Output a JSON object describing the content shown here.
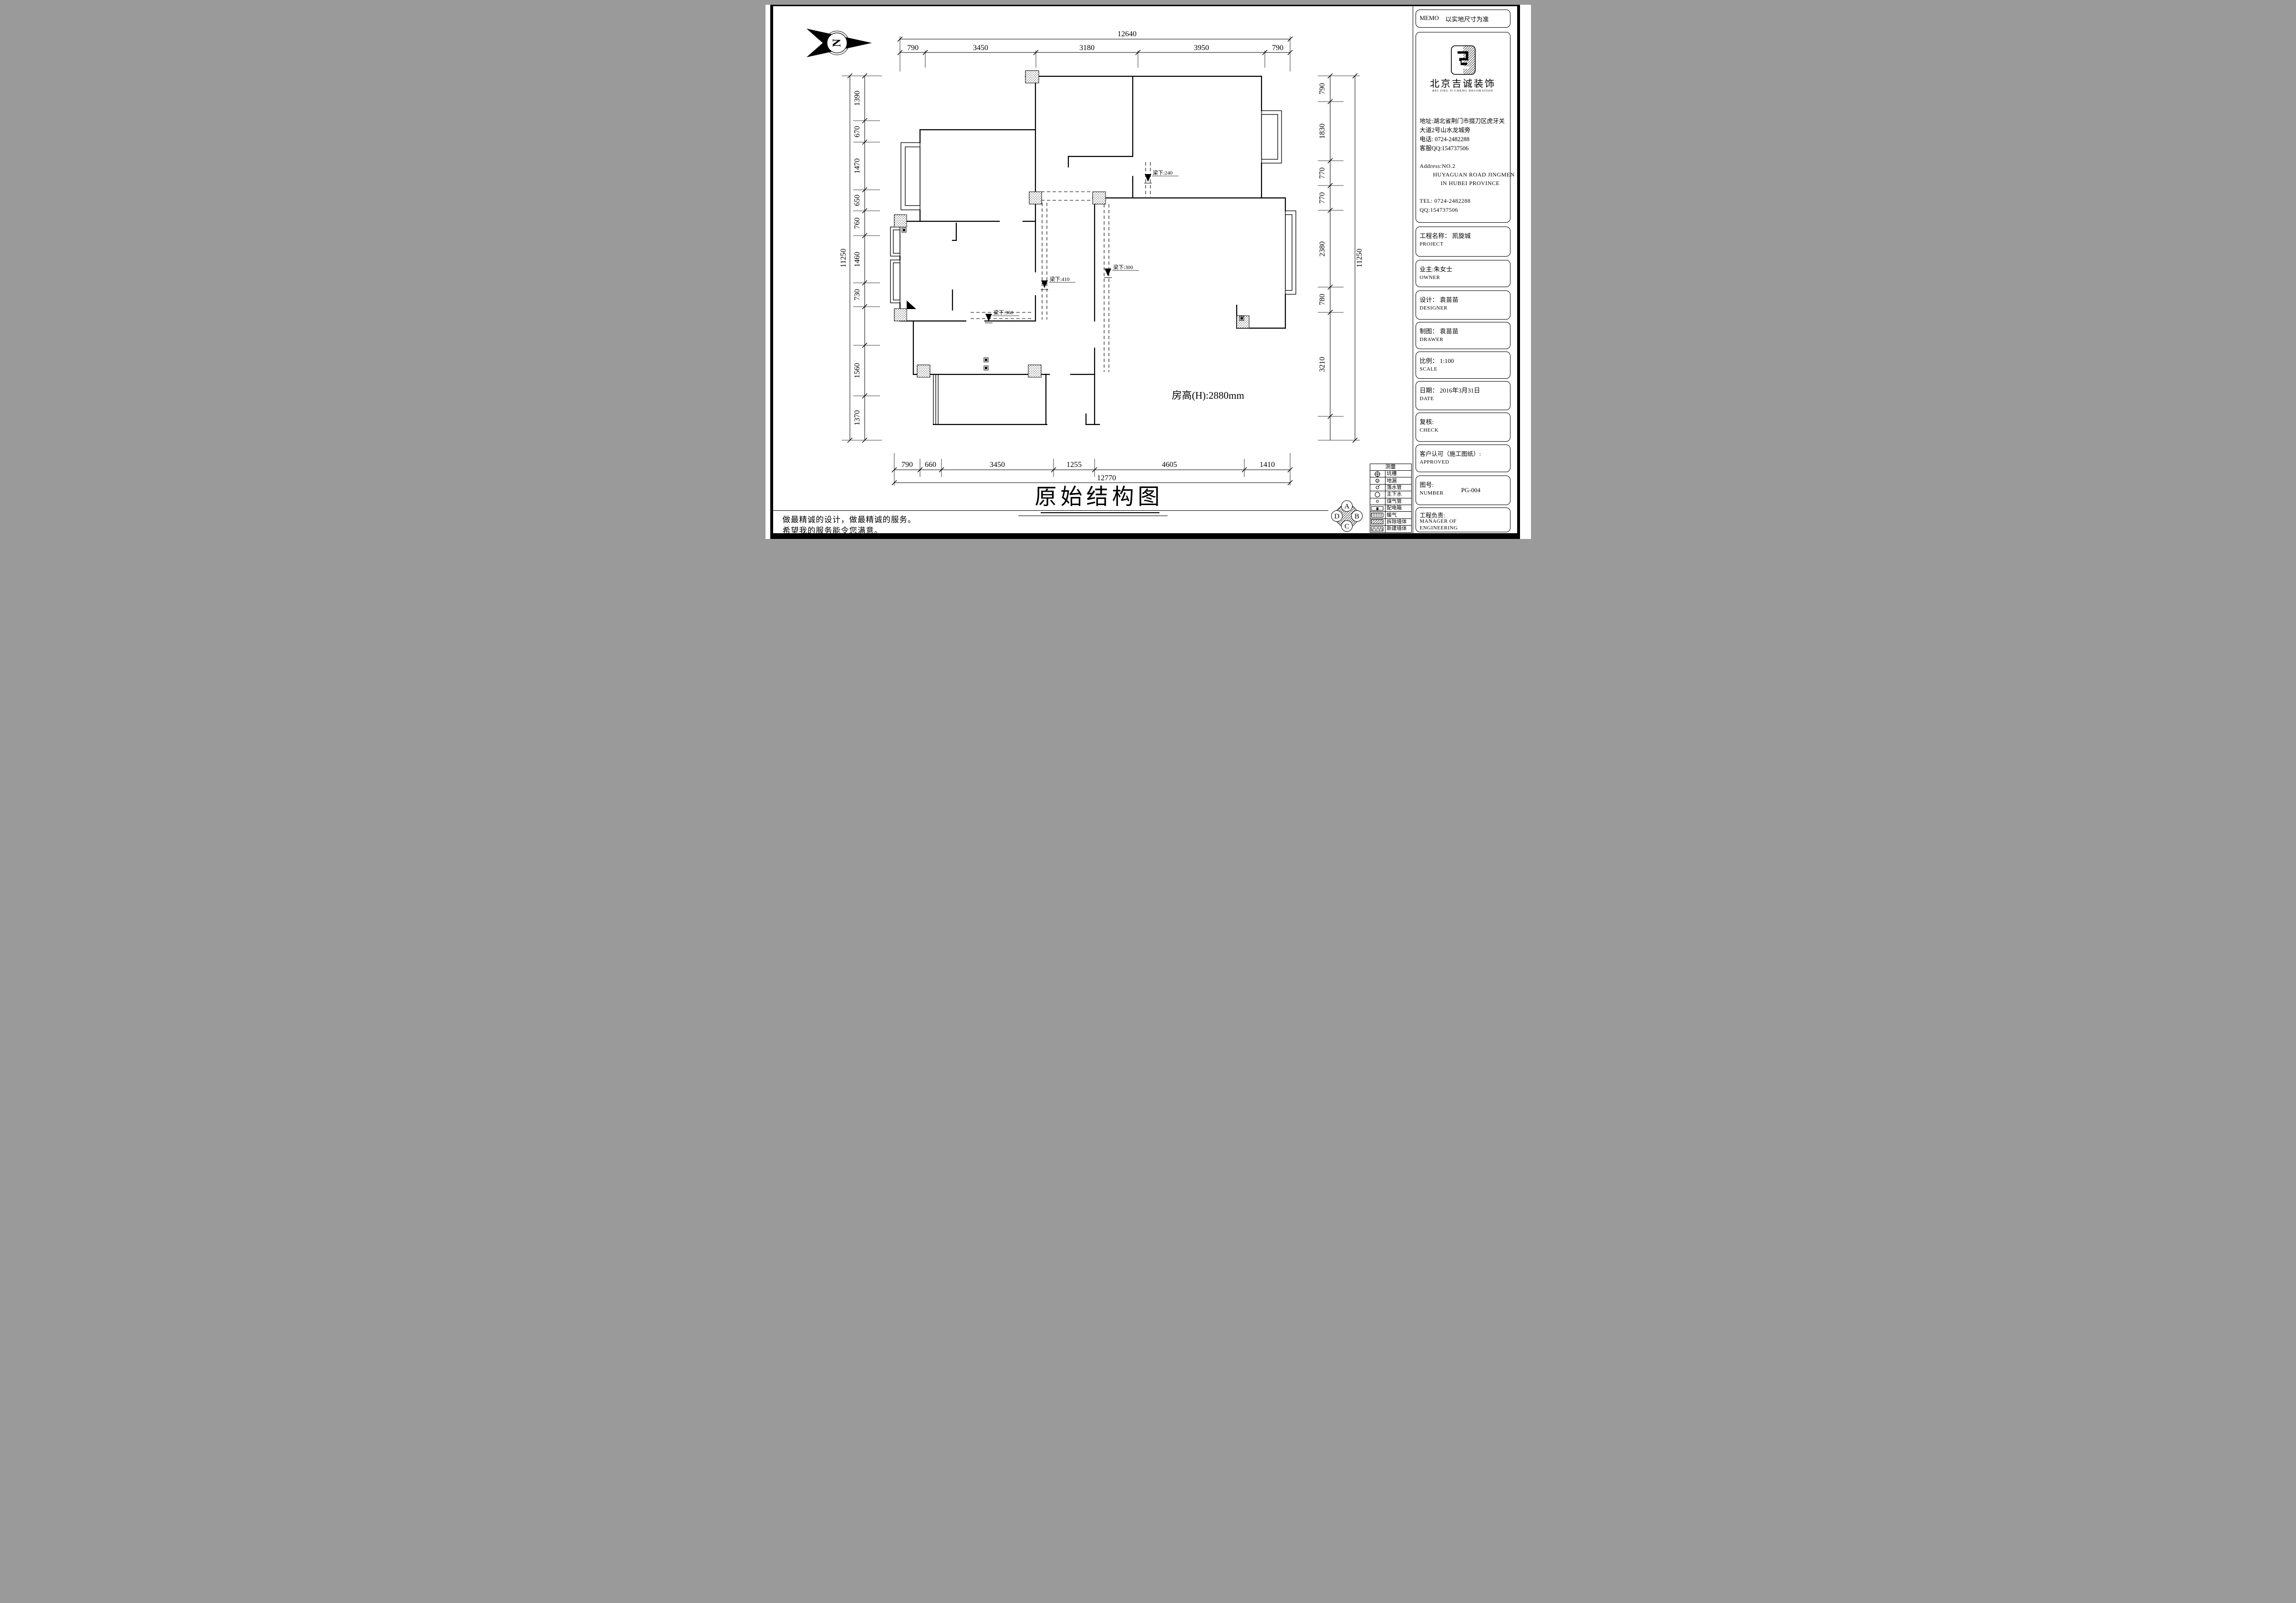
{
  "north": {
    "letter": "N"
  },
  "dims": {
    "top": {
      "overall": "12640",
      "segments": [
        "790",
        "3450",
        "3180",
        "3950",
        "790"
      ]
    },
    "bottom": {
      "overall": "12770",
      "segments": [
        "790",
        "660",
        "3450",
        "1255",
        "4605",
        "1410"
      ]
    },
    "left": {
      "overall": "11250",
      "segments": [
        "1390",
        "670",
        "1470",
        "650",
        "760",
        "1460",
        "730",
        "1560",
        "1370"
      ]
    },
    "right": {
      "overall": "11250",
      "segments": [
        "790",
        "1830",
        "770",
        "770",
        "2380",
        "780",
        "3210"
      ]
    }
  },
  "plan": {
    "room_height": "房高(H):2880mm",
    "beams": [
      {
        "label": "梁下:240"
      },
      {
        "label": "梁下:300"
      },
      {
        "label": "梁下:410"
      },
      {
        "label": "梁下:360"
      }
    ]
  },
  "drawing_title": "原始结构图",
  "slogan": {
    "line1": "做最精诚的设计，做最精诚的服务。",
    "line2": "希望我的服务能令您满意。"
  },
  "legend": {
    "header": "测量",
    "rows": [
      {
        "name": "坑槽",
        "symbol": "pit-marker-icon"
      },
      {
        "name": "地漏",
        "symbol": "floor-drain-icon"
      },
      {
        "name": "落水管",
        "symbol": "downpipe-icon"
      },
      {
        "name": "主下水",
        "symbol": "main-drain-icon"
      },
      {
        "name": "煤气管",
        "symbol": "gas-pipe-icon"
      },
      {
        "name": "配电箱",
        "symbol": "distribution-box-icon"
      },
      {
        "name": "暖气",
        "symbol": "radiator-icon"
      },
      {
        "name": "拆除墙体",
        "symbol": "demolished-wall-icon"
      },
      {
        "name": "新建墙体",
        "symbol": "new-wall-icon"
      }
    ]
  },
  "compass": {
    "top": "A",
    "right": "B",
    "bottom": "C",
    "left": "D"
  },
  "titleblock": {
    "memo_label": "MEMO",
    "memo_note": "以实地尺寸为准",
    "company_name": "北京吉诚装饰",
    "company_name_en": "BEI JING   JI CHENG   DECORATION",
    "address_line1": "地址:湖北省荆门市掇刀区虎牙关",
    "address_line2": "大道2号山水龙城旁",
    "phone": "电话: 0724-2482288",
    "qq": "客服QQ:154737506",
    "address_en_line1": "Address:NO.2",
    "address_en_line2": "HUYAGUAN ROAD JINGMEN",
    "address_en_line3": "IN HUBEI PROVINCE",
    "tel_en": "TEL: 0724-2482288",
    "qq_en": "QQ:154737506",
    "project_label": "工程名称：  凯旋城",
    "project_en": "PROJECT",
    "owner_label": "业主:朱女士",
    "owner_en": "OWNER",
    "designer_label": "设计：  袁苗苗",
    "designer_en": "DESIGNER",
    "drawer_label": "制图：  袁苗苗",
    "drawer_en": "DRAWER",
    "scale_label": "比例：  1:100",
    "scale_en": "SCALE",
    "date_label": "日期：  2016年3月31日",
    "date_en": "DATE",
    "check_label": "复核:",
    "check_en": "CHECK",
    "approved_label": "客户认可（施工图纸）:",
    "approved_en": "APPROVED",
    "number_label": "图号:",
    "number_en": "NUMBER",
    "number_value": "PG-004",
    "manager_label": "工程负责:",
    "manager_en_line1": "MANAGER OF",
    "manager_en_line2": "ENGINEERING"
  }
}
